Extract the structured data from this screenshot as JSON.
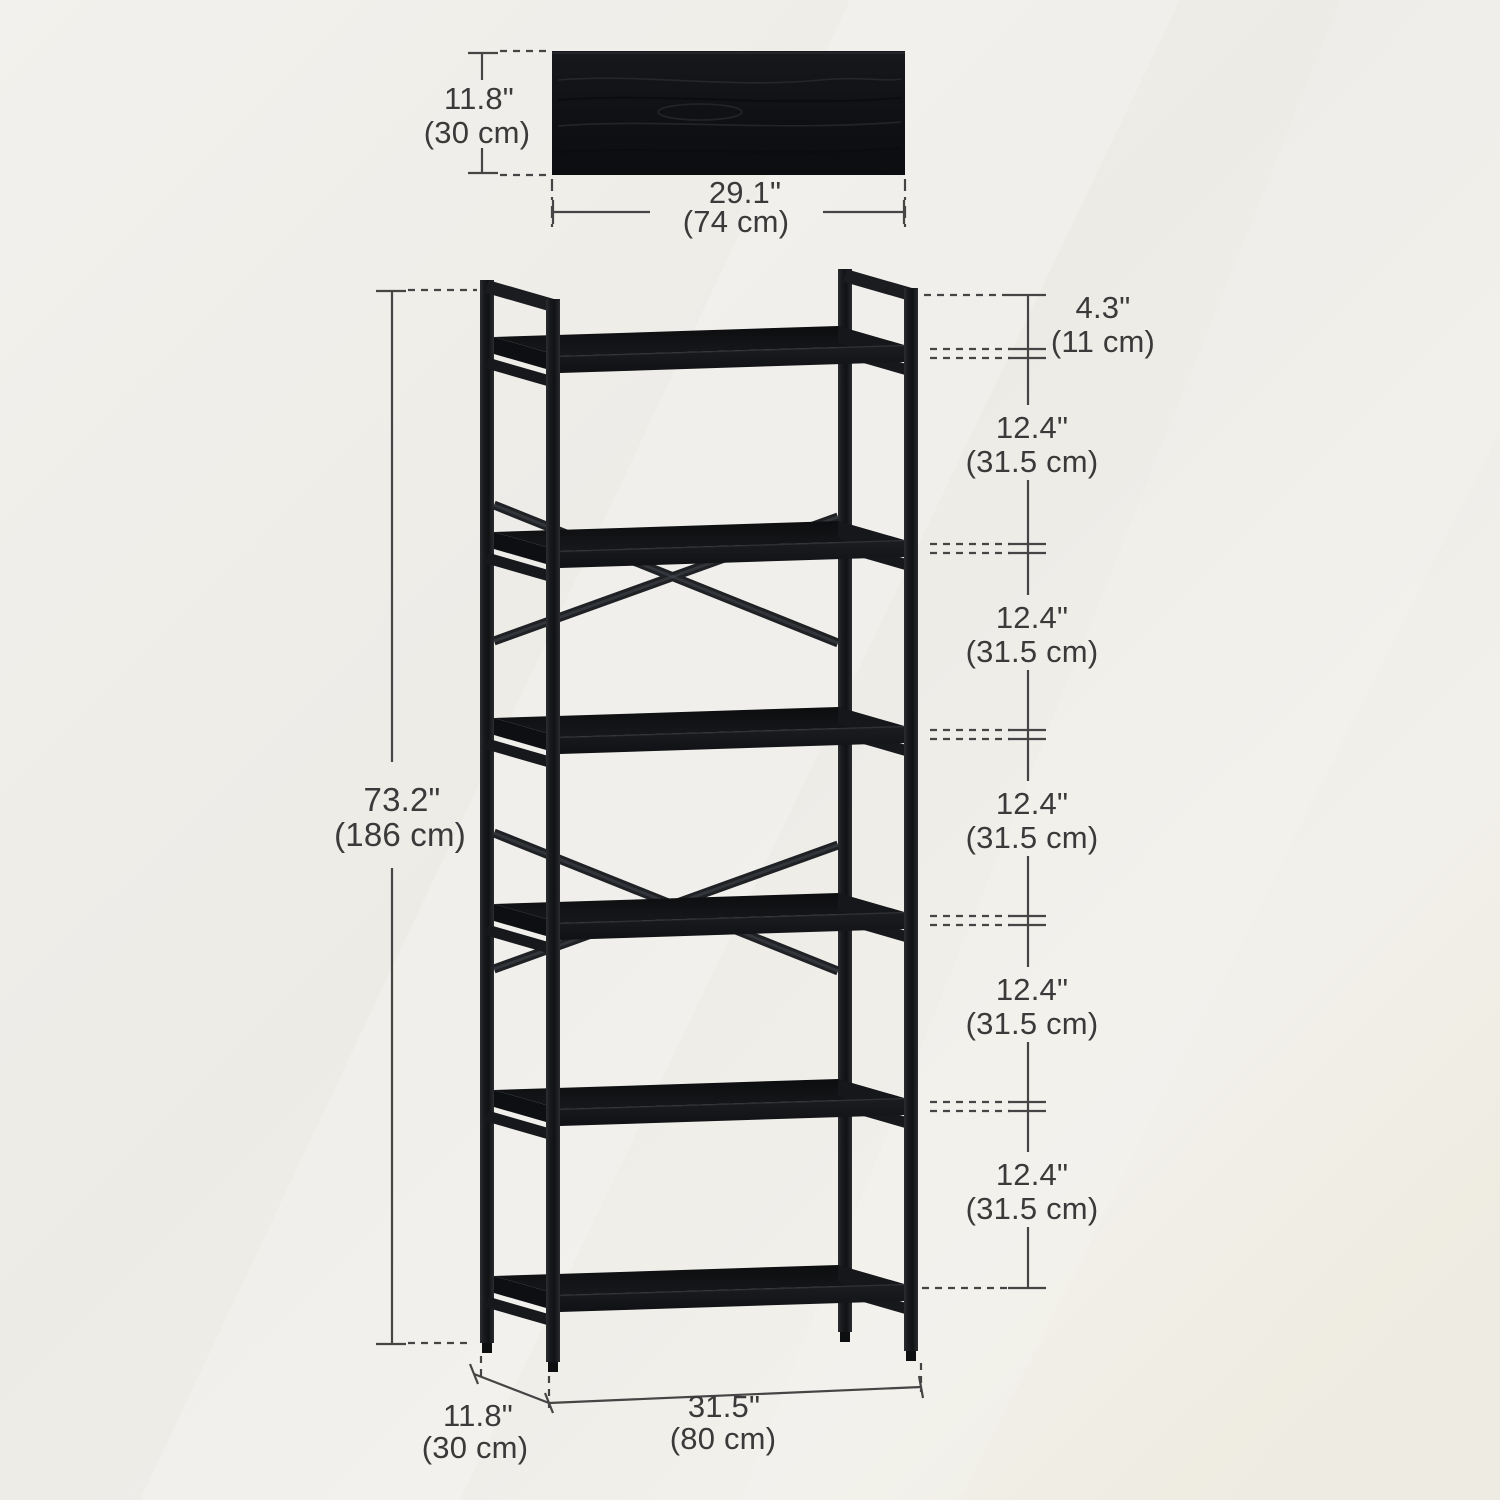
{
  "panel": {
    "height_in": "11.8\"",
    "height_cm": "(30 cm)",
    "width_in": "29.1\"",
    "width_cm": "(74 cm)"
  },
  "bookshelf": {
    "total_height_in": "73.2\"",
    "total_height_cm": "(186 cm)",
    "top_gap_in": "4.3\"",
    "top_gap_cm": "(11 cm)",
    "tier_gaps": [
      {
        "in": "12.4\"",
        "cm": "(31.5 cm)"
      },
      {
        "in": "12.4\"",
        "cm": "(31.5 cm)"
      },
      {
        "in": "12.4\"",
        "cm": "(31.5 cm)"
      },
      {
        "in": "12.4\"",
        "cm": "(31.5 cm)"
      },
      {
        "in": "12.4\"",
        "cm": "(31.5 cm)"
      }
    ],
    "depth_in": "11.8\"",
    "depth_cm": "(30 cm)",
    "width_in": "31.5\"",
    "width_cm": "(80 cm)"
  },
  "colors": {
    "background": "#f0eeea",
    "dimension_line": "#454545",
    "text": "#3a3a3a",
    "metal_frame": "#1d1f22",
    "wood_board": "#111215"
  }
}
